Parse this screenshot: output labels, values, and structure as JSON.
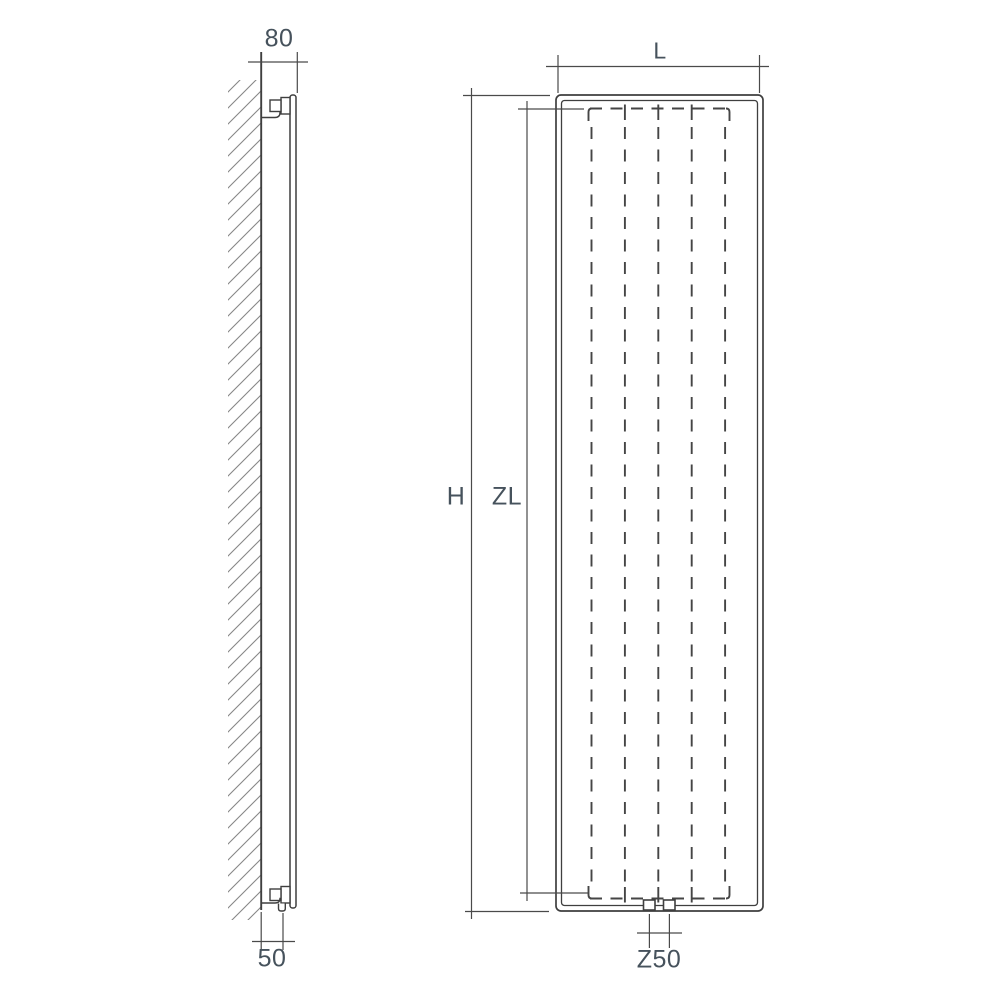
{
  "diagram": {
    "type": "technical-dimension-drawing",
    "subject": "vertical-panel-radiator",
    "labels": {
      "wall_to_front_depth": "80",
      "wall_to_connection": "50",
      "total_width": "L",
      "total_height": "H",
      "axial_height": "ZL",
      "connection_spacing": "Z50"
    },
    "views": {
      "side_view": {
        "features": [
          "wall-hatch",
          "mounting-bracket-top",
          "mounting-bracket-bottom",
          "panel-profile"
        ]
      },
      "front_view": {
        "channel_count": 5,
        "connection_count": 2,
        "features": [
          "panel-outline",
          "dashed-water-channels",
          "bottom-connections"
        ]
      }
    },
    "colors": {
      "outline": "#3f3f3f",
      "dimension_line": "#4a4a4a",
      "hatch": "#878787",
      "label_text": "#46525c",
      "background": "#ffffff"
    }
  }
}
